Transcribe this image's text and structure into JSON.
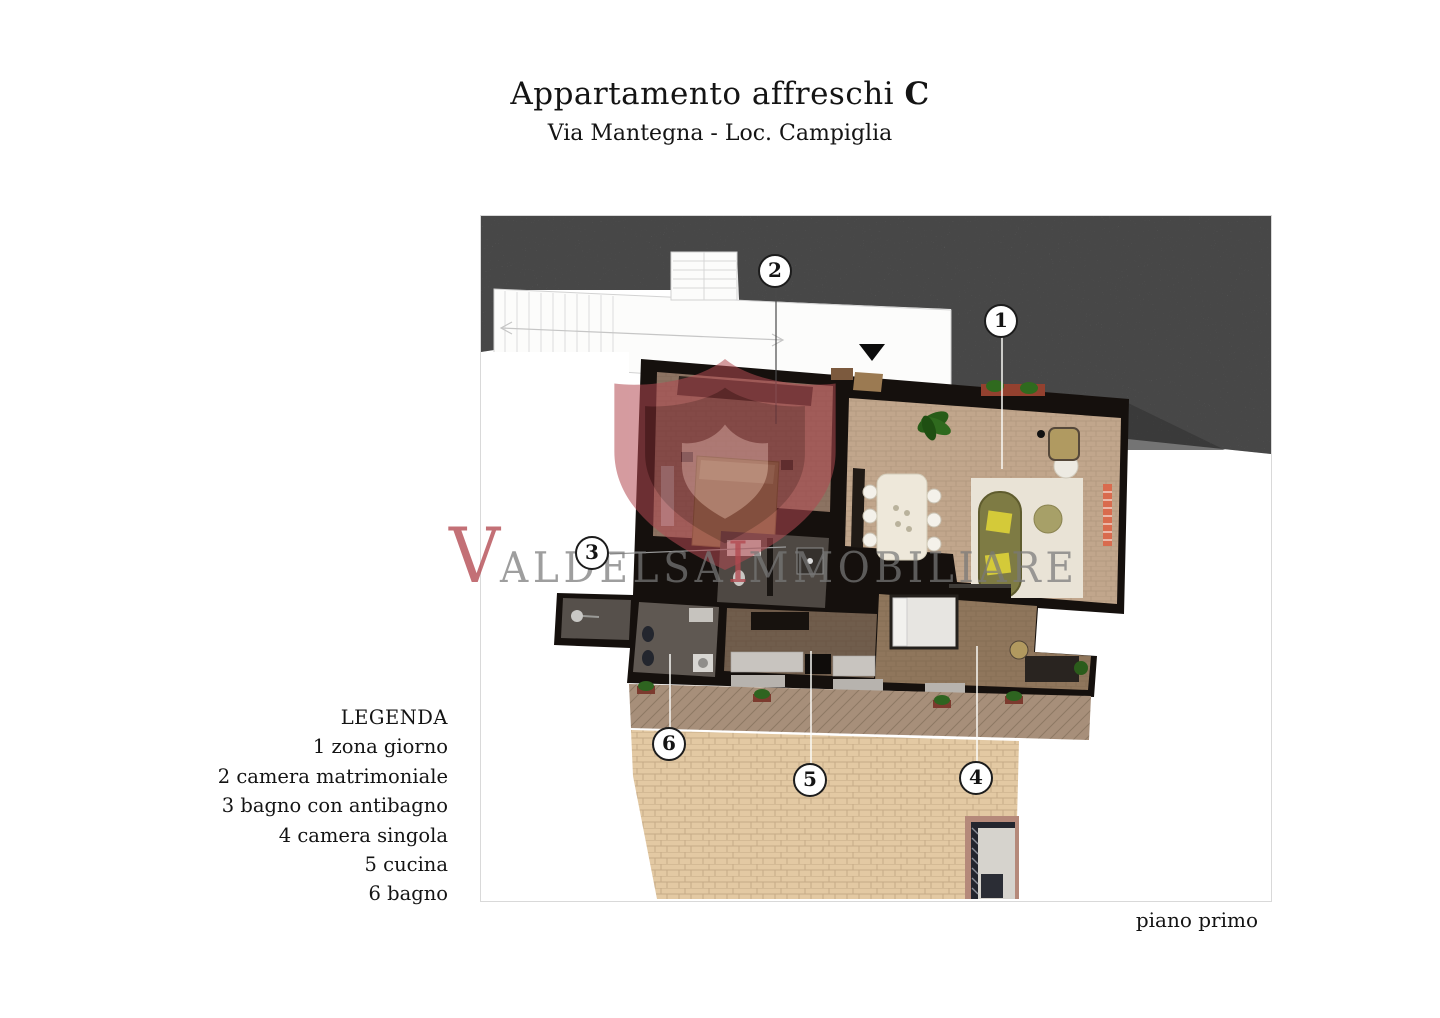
{
  "header": {
    "title_main": "Appartamento affreschi ",
    "title_bold": "C",
    "subtitle": "Via Mantegna - Loc. Campiglia"
  },
  "legend": {
    "heading": "LEGENDA",
    "items": [
      {
        "num": "1",
        "label": "zona giorno"
      },
      {
        "num": "2",
        "label": "camera matrimoniale"
      },
      {
        "num": "3",
        "label": "bagno con antibagno"
      },
      {
        "num": "4",
        "label": "camera singola"
      },
      {
        "num": "5",
        "label": "cucina"
      },
      {
        "num": "6",
        "label": "bagno"
      }
    ]
  },
  "plan": {
    "floor_label": "piano primo",
    "callouts": [
      "1",
      "2",
      "3",
      "4",
      "5",
      "6"
    ]
  },
  "watermark": {
    "letter_v": "V",
    "word_aldelsa": "ALDELSA",
    "letter_i": "I",
    "word_immobiliare": "MMOBILIARE"
  },
  "colors": {
    "accent_red": "#b2484f",
    "concrete_gray": "#8d8d8d",
    "wall_dark": "#15100d",
    "terrace_beige": "#e3c9a3",
    "floor_living": "#c2a78c",
    "sofa_olive": "#7e7b44"
  }
}
